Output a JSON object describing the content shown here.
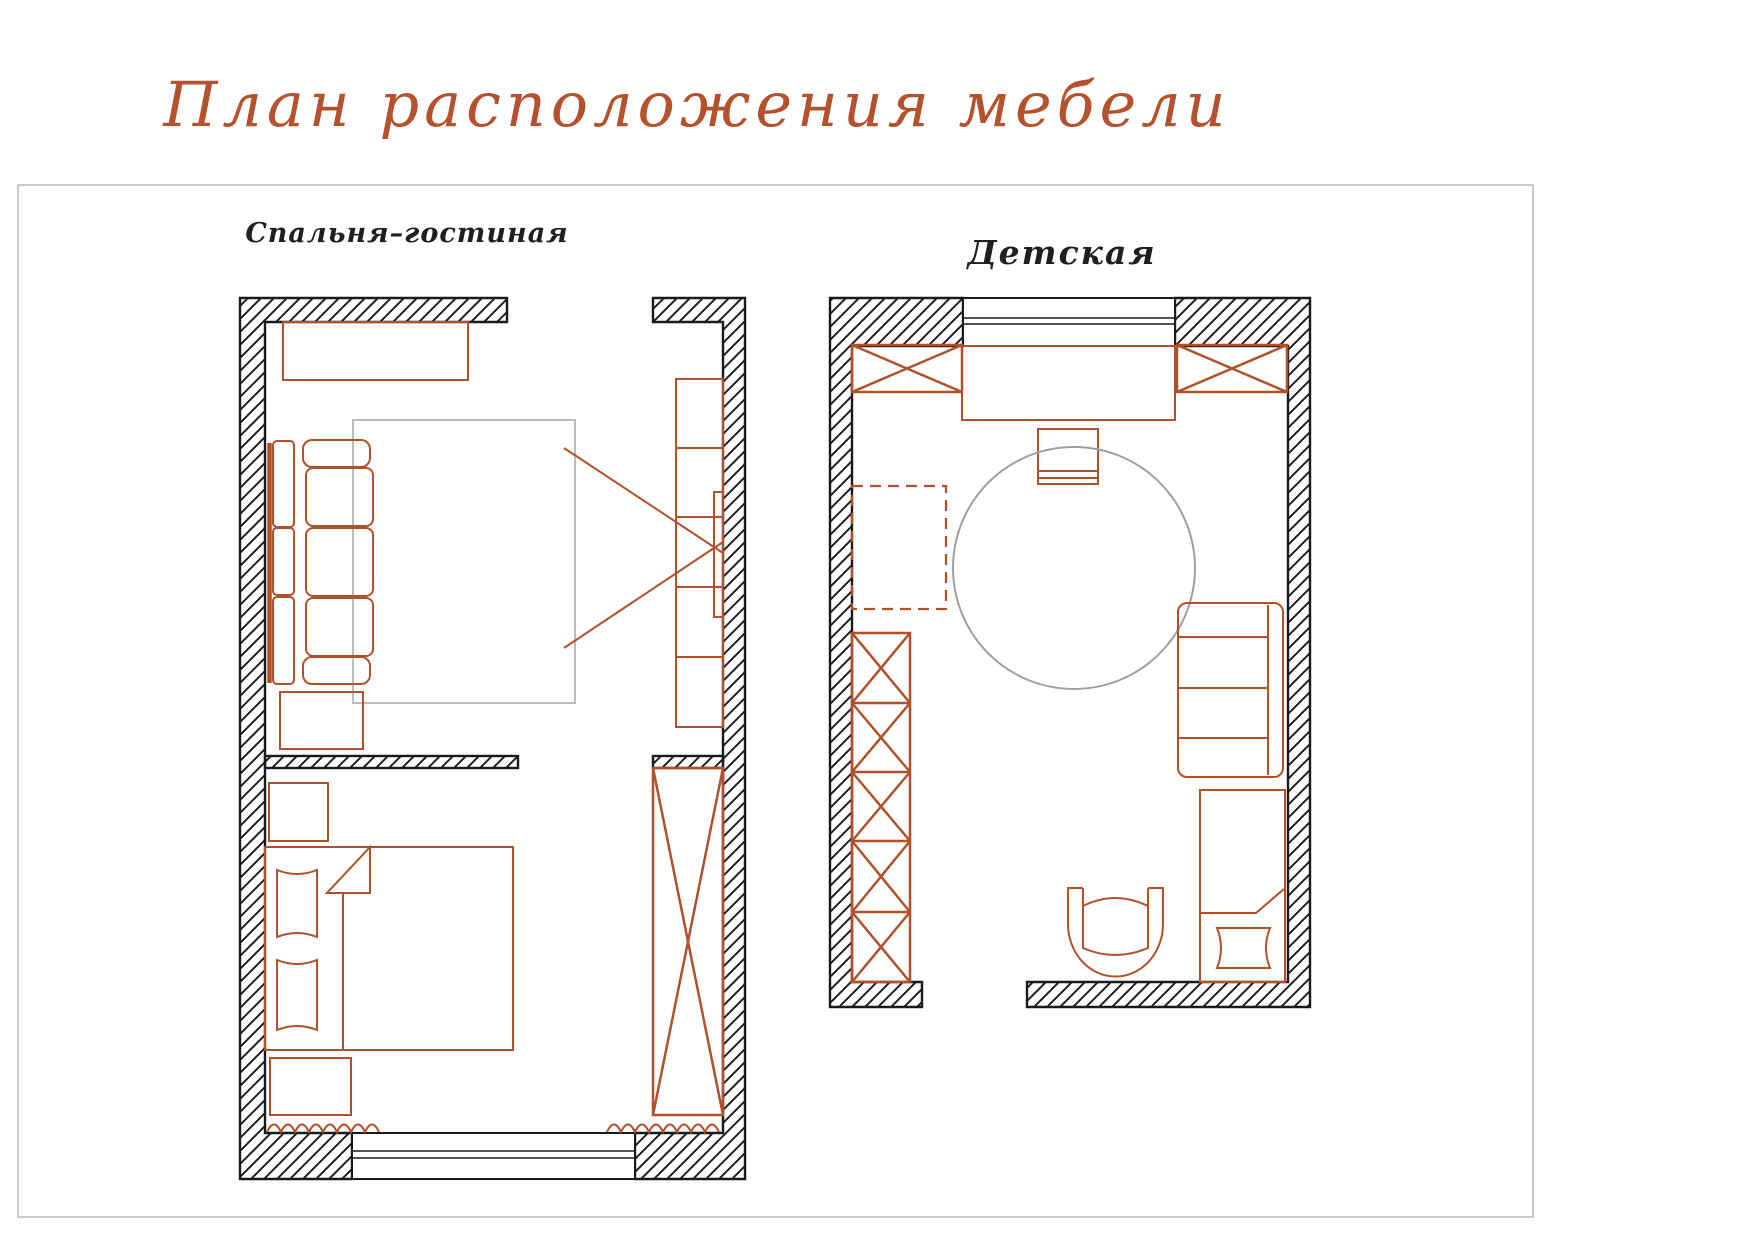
{
  "title": "План расположения мебели",
  "plans": {
    "bedroom_living": {
      "label": "Спальня–гостиная"
    },
    "childrens": {
      "label": "Детская"
    }
  },
  "colors": {
    "accent": "#b0512b",
    "ink": "#1a1a1a",
    "rug_gray": "#bcbcbc",
    "circle_gray": "#9aa0a5",
    "frame_gray": "#a8a8a8",
    "title": "#b5512c",
    "label": "#1f1f1f"
  }
}
